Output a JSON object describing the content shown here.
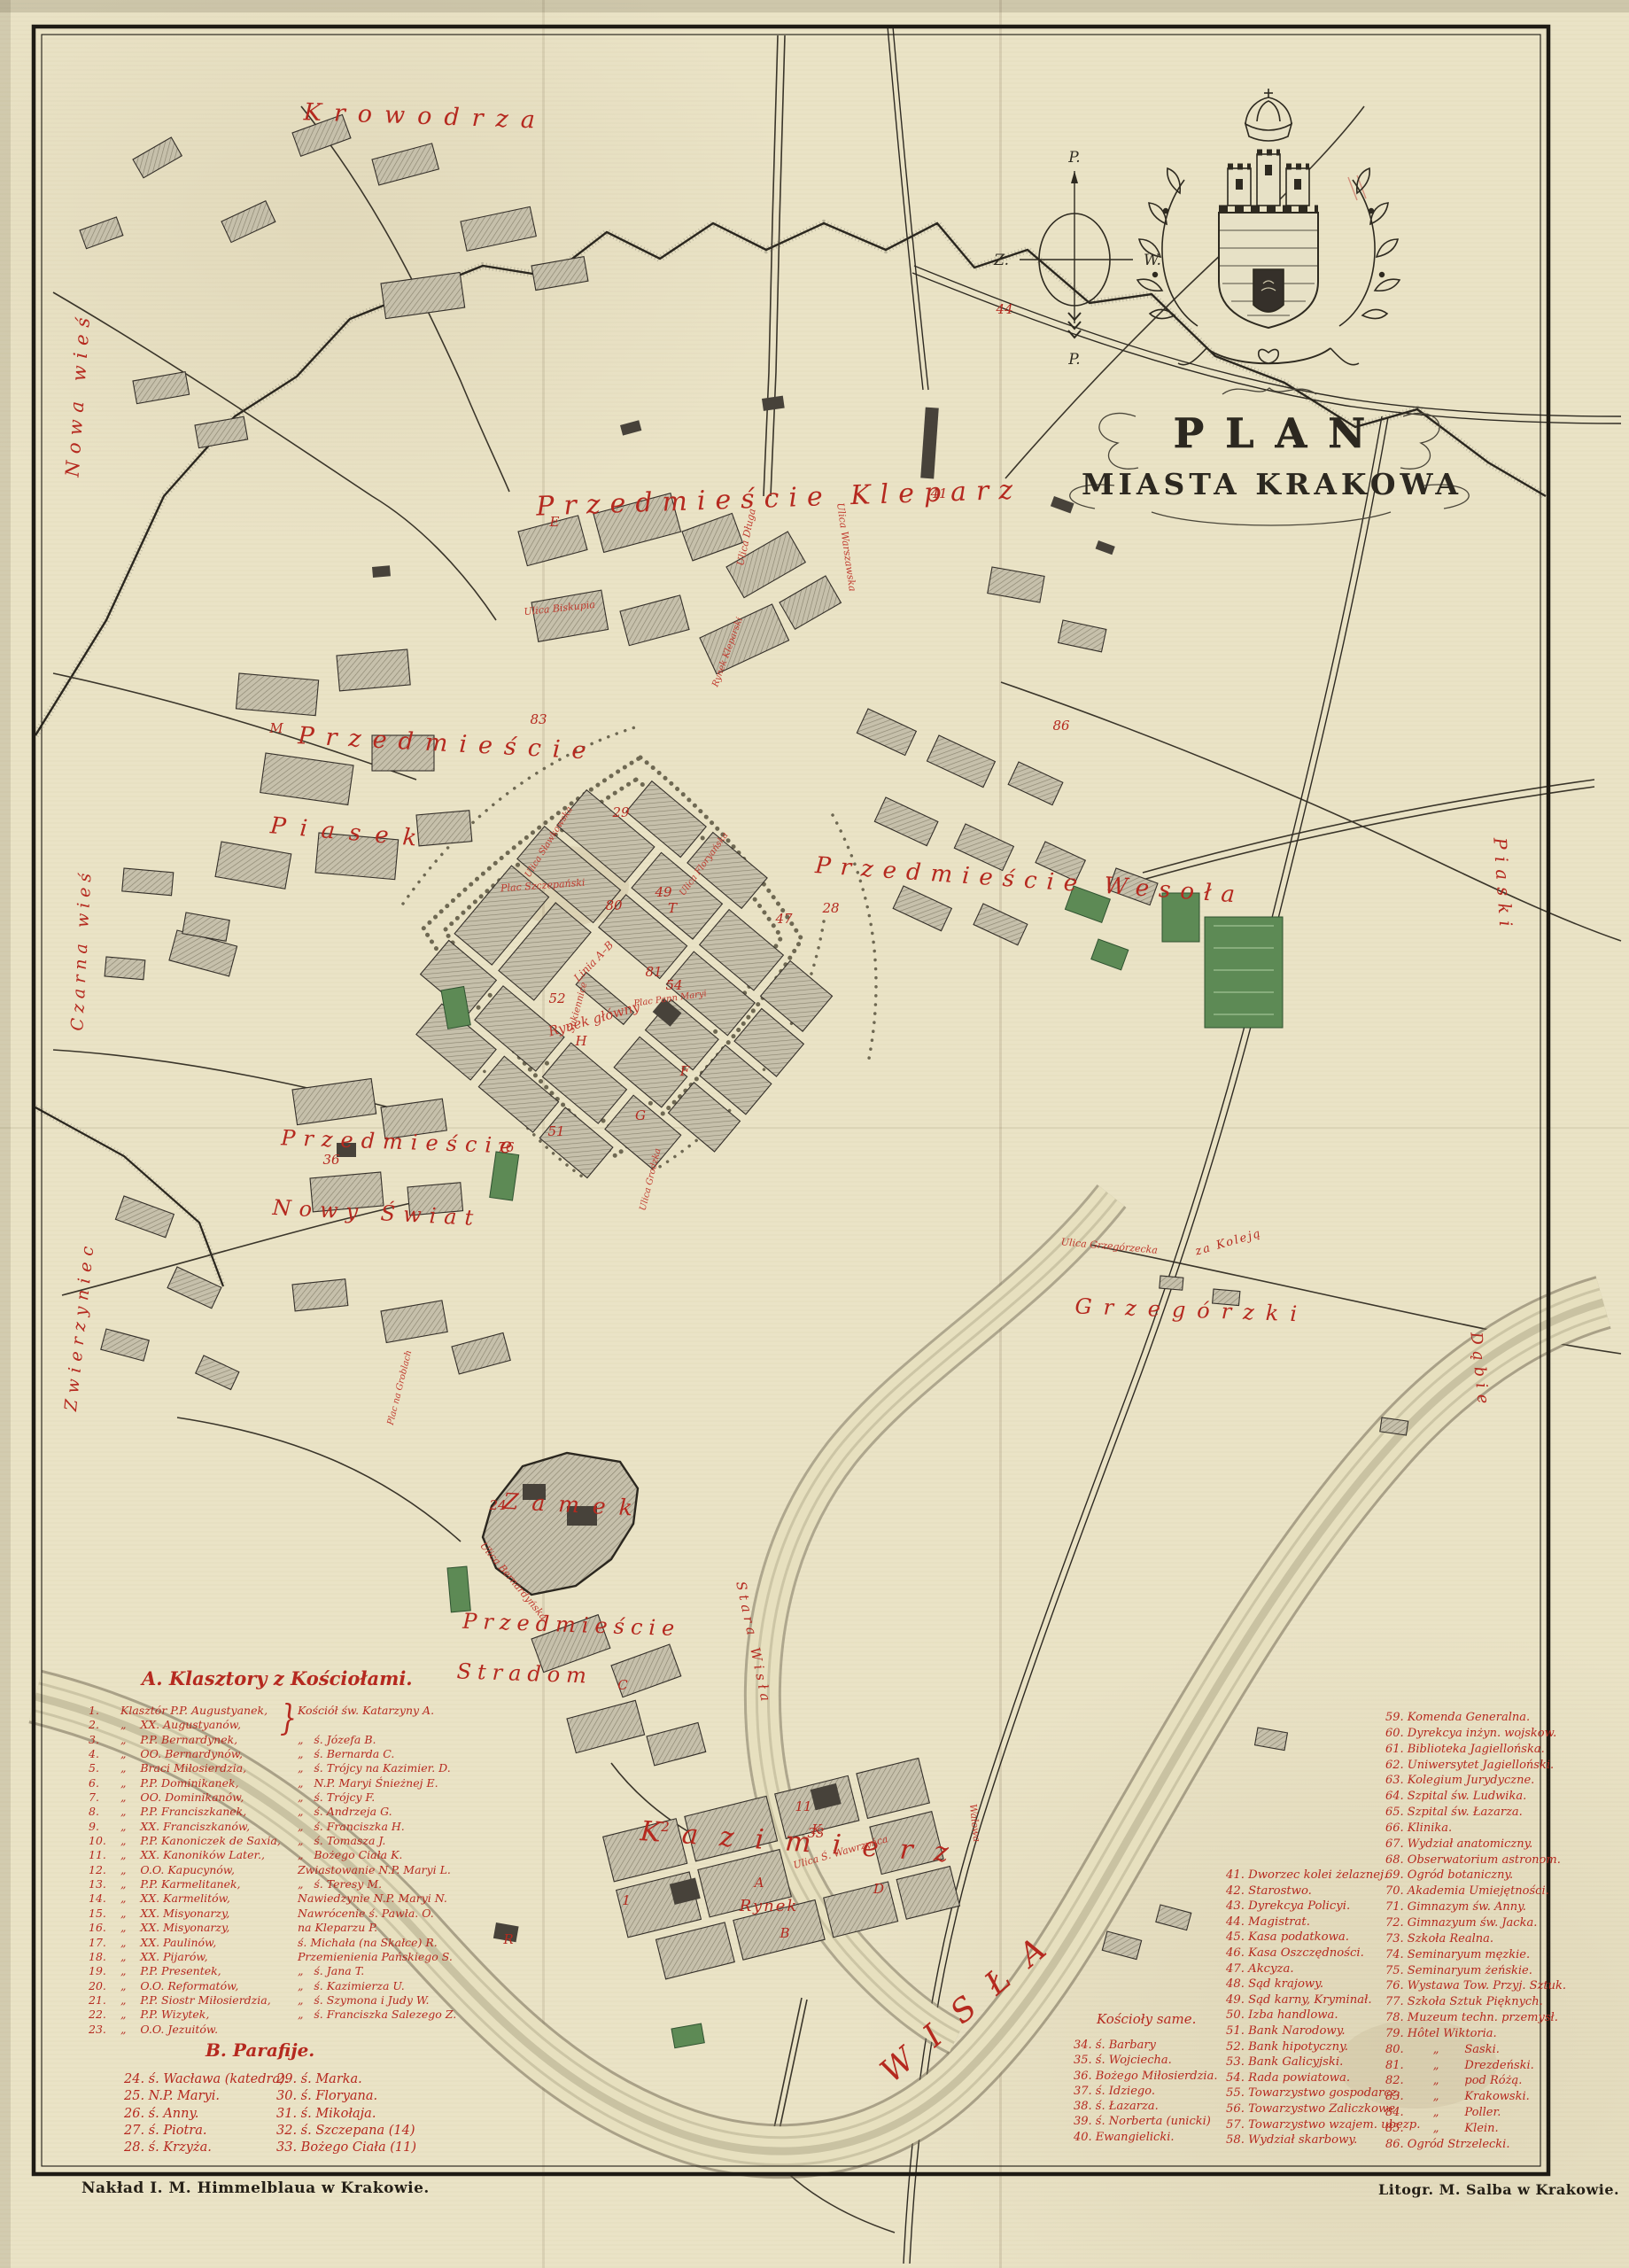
{
  "title": {
    "plan": "PLAN",
    "city": "MIASTA KRAKOWA"
  },
  "compass": {
    "n": "P.",
    "w": "Z.",
    "e": "W.",
    "s": "P."
  },
  "imprint": {
    "left": "Nakład I. M. Himmelblaua w Krakowie.",
    "right": "Litogr. M. Salba w Krakowie."
  },
  "legend_a": {
    "title": "A. Klasztory z Kościołami.",
    "brace": "}",
    "rows": [
      [
        "1.",
        "Klasztór P.P. Augustyanek,",
        "Kościół św. Katarzyny A."
      ],
      [
        "2.",
        "„    XX. Augustyanów,",
        ""
      ],
      [
        "3.",
        "„    P.P. Bernardynek,",
        "„   ś. Józefa B."
      ],
      [
        "4.",
        "„    OO. Bernardynów,",
        "„   ś. Bernarda C."
      ],
      [
        "5.",
        "„    Braci Miłosierdzia,",
        "„   ś. Trójcy na Kazimier. D."
      ],
      [
        "6.",
        "„    P.P. Dominikanek,",
        "„   N.P. Maryi Śnieżnej E."
      ],
      [
        "7.",
        "„    OO. Dominikanów,",
        "„   ś. Trójcy F."
      ],
      [
        "8.",
        "„    P.P. Franciszkanek,",
        "„   ś. Andrzeja G."
      ],
      [
        "9.",
        "„    XX. Franciszkanów,",
        "„   ś. Franciszka H."
      ],
      [
        "10.",
        "„    P.P. Kanoniczek de Saxia,",
        "„   ś. Tomasza J."
      ],
      [
        "11.",
        "„    XX. Kanoników Later.,",
        "„   Bożego Ciała K."
      ],
      [
        "12.",
        "„    O.O. Kapucynów,",
        "Zwiastowanie N.P. Maryi L."
      ],
      [
        "13.",
        "„    P.P. Karmelitanek,",
        "„   ś. Teresy M."
      ],
      [
        "14.",
        "„    XX. Karmelitów,",
        "Nawiedzynie N.P. Maryi N."
      ],
      [
        "15.",
        "„    XX. Misyonarzy,",
        "Nawrócenie ś. Pawła. O."
      ],
      [
        "16.",
        "„    XX. Misyonarzy,",
        "na Kleparzu P."
      ],
      [
        "17.",
        "„    XX. Paulinów,",
        "ś. Michała (na Skałce) R."
      ],
      [
        "18.",
        "„    XX. Pijarów,",
        "Przemienienia Pańskiego S."
      ],
      [
        "19.",
        "„    P.P. Presentek,",
        "„   ś. Jana T."
      ],
      [
        "20.",
        "„    O.O. Reformatów,",
        "„   ś. Kazimierza U."
      ],
      [
        "21.",
        "„    P.P. Siostr Miłosierdzia,",
        "„   ś. Szymona i Judy W."
      ],
      [
        "22.",
        "„    P.P. Wizytek,",
        "„   ś. Franciszka Salezego Z."
      ],
      [
        "23.",
        "„    O.O. Jezuitów.",
        ""
      ]
    ]
  },
  "legend_b": {
    "title": "B. Parafije.",
    "col1": [
      "24. ś. Wacława (katedra).",
      "25. N.P. Maryi.",
      "26. ś. Anny.",
      "27. ś. Piotra.",
      "28. ś. Krzyża."
    ],
    "col2": [
      "29. ś. Marka.",
      "30. ś. Floryana.",
      "31. ś. Mikołaja.",
      "32. ś. Szczepana (14)",
      "33. Bożego Ciała (11)"
    ]
  },
  "koscioly": {
    "title": "Kościoły same.",
    "items": [
      "34. ś. Barbary",
      "35. ś. Wojciecha.",
      "36. Bożego Miłosierdzia.",
      "37. ś. Idziego.",
      "38. ś. Łazarza.",
      "39. ś. Norberta (unicki)",
      "40. Ewangielicki."
    ]
  },
  "offices": {
    "items": [
      "41. Dworzec kolei żelaznej.",
      "42. Starostwo.",
      "43. Dyrekcya Policyi.",
      "44. Magistrat.",
      "45. Kasa podatkowa.",
      "46. Kasa Oszczędności.",
      "47. Akcyza.",
      "48. Sąd krajowy.",
      "49. Sąd karny, Kryminał.",
      "50. Izba handlowa.",
      "51. Bank Narodowy.",
      "52. Bank hipotyczny.",
      "53. Bank Galicyjski.",
      "54. Rada powiatowa.",
      "55. Towarzystwo gospodarcz.",
      "56. Towarzystwo Zaliczkowe.",
      "57. Towarzystwo wzajem. ubezp.",
      "58. Wydział skarbowy."
    ]
  },
  "institutions": {
    "items": [
      "59. Komenda Generalna.",
      "60. Dyrekcya inżyn. wojskow.",
      "61. Biblioteka Jagiellońska.",
      "62. Uniwersytet Jagielloński.",
      "63. Kolegium Jurydyczne.",
      "64. Szpital św. Ludwika.",
      "65. Szpital św. Łazarza.",
      "66. Klinika.",
      "67. Wydział anatomiczny.",
      "68. Obserwatorium astronom.",
      "69. Ogród botaniczny.",
      "70. Akademia Umiejętności.",
      "71. Gimnazym św. Anny.",
      "72. Gimnazyum św. Jacka.",
      "73. Szkoła Realna.",
      "74. Seminaryum męzkie.",
      "75. Seminaryum żeńskie.",
      "76. Wystawa Tow. Przyj. Sztuk.",
      "77. Szkoła Sztuk Pięknych.",
      "78. Muzeum techn. przemysł.",
      "79. Hôtel Wiktoria.",
      "80.        „       Saski.",
      "81.        „       Drezdeński.",
      "82.        „       pod Różą.",
      "83.        „       Krakowski.",
      "84.        „       Poller.",
      "85.        „       Klein.",
      "86. Ogród Strzelecki."
    ]
  },
  "map": {
    "districts": {
      "krowodrza": "Krowodrza",
      "nowa_wies": "Nowa wieś",
      "kleparz": "Przedmieście Kleparz",
      "przedm_piasek": "Przedmieście",
      "piasek": "Piasek",
      "czarna_wies": "Czarna wieś",
      "wesola": "Przedmieście Wesoła",
      "piaski": "Piaski",
      "przedm2": "Przedmieście",
      "nowy_swiat": "Nowy Świat",
      "zwierzyniec": "Zwierzyniec",
      "grzegorzki": "Grzegórzki",
      "dabie": "Dąbie",
      "zamek": "Zamek",
      "stradom1": "Przedmieście",
      "stradom2": "Stradom",
      "kazimierz": "Kazimierz",
      "rynek_kaz": "Rynek",
      "wisla": "WISŁA",
      "stara_wisla": "Stara Wisła",
      "za_koleja": "za Koleją"
    },
    "streets": {
      "rynek_glowny": "Rynek główny",
      "sukiennice": "Sukiennice",
      "plac_szczep": "Plac Szczepański",
      "plac_maryi": "Plac Pann Maryi",
      "linia_ab": "Linia A–B",
      "floryanska": "Ulica Floryańska",
      "grodzka": "Ulica Grodzka",
      "slawkowska": "Ulica Sławkowska",
      "biskupia": "Ulica Biskupia",
      "warszawska": "Ulica Warszawska",
      "bernardynska": "Ulica Bernardyńska",
      "grzegorzecka": "Ulica Grzegórzecka",
      "wawrzynca": "Ulica Ś. Wawrzyńca",
      "walowa": "Wałowa",
      "groblach": "Plac na Groblach",
      "dluga": "Ulica Długa",
      "rynek_klep": "Rynek Kleparski"
    },
    "marks": [
      "41",
      "44",
      "86",
      "24",
      "36",
      "29",
      "80",
      "81",
      "54",
      "49",
      "47",
      "28",
      "52",
      "33",
      "11",
      "2",
      "1",
      "83",
      "76",
      "51",
      "A",
      "K",
      "R",
      "T",
      "D",
      "H",
      "G",
      "C",
      "B",
      "F",
      "E",
      "M"
    ]
  }
}
